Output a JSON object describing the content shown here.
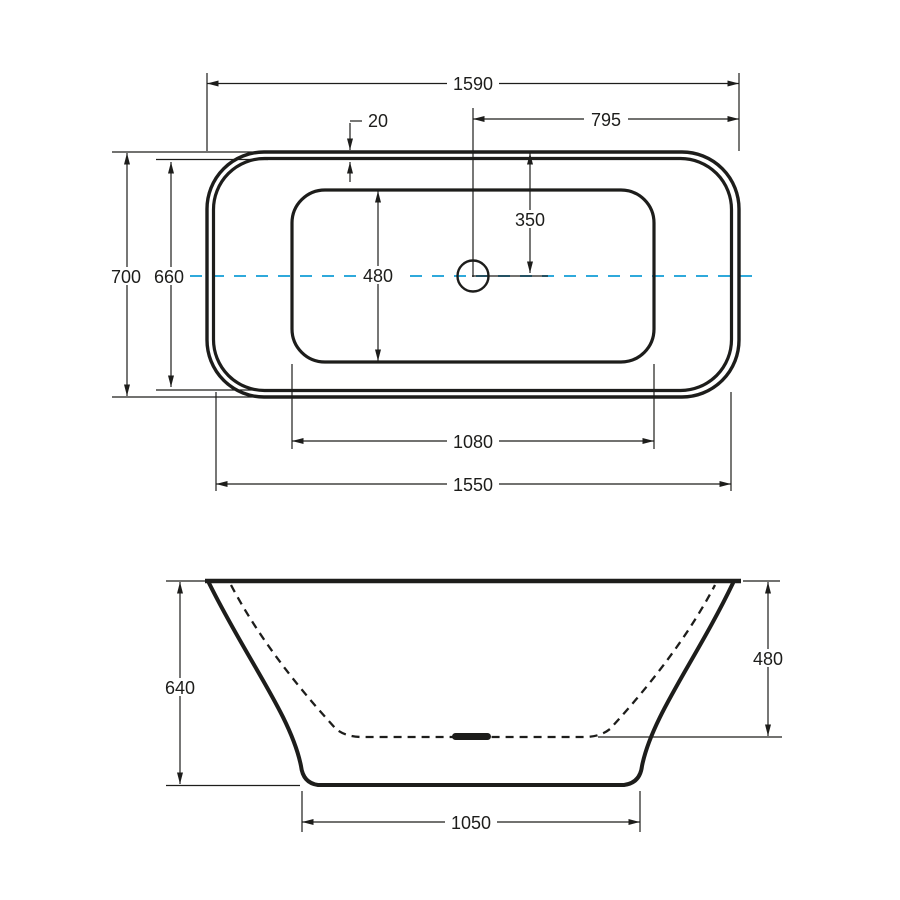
{
  "page": {
    "title": "Freestanding bathtub dimensional drawing"
  },
  "colors": {
    "line": "#1d1d1b",
    "centerline": "#2fa9db",
    "background": "#ffffff"
  },
  "top_view": {
    "name": "top-plan-view",
    "dimensions": {
      "overall_length": "1590",
      "rim_offset": "20",
      "center_to_right_end": "795",
      "top_edge_to_center": "350",
      "basin_width": "480",
      "overall_width": "700",
      "rim_inner_width": "660",
      "basin_length": "1080",
      "rim_inner_length": "1550"
    }
  },
  "side_view": {
    "name": "front-elevation-view",
    "dimensions": {
      "overall_height": "640",
      "inner_depth": "480",
      "base_length": "1050"
    }
  }
}
